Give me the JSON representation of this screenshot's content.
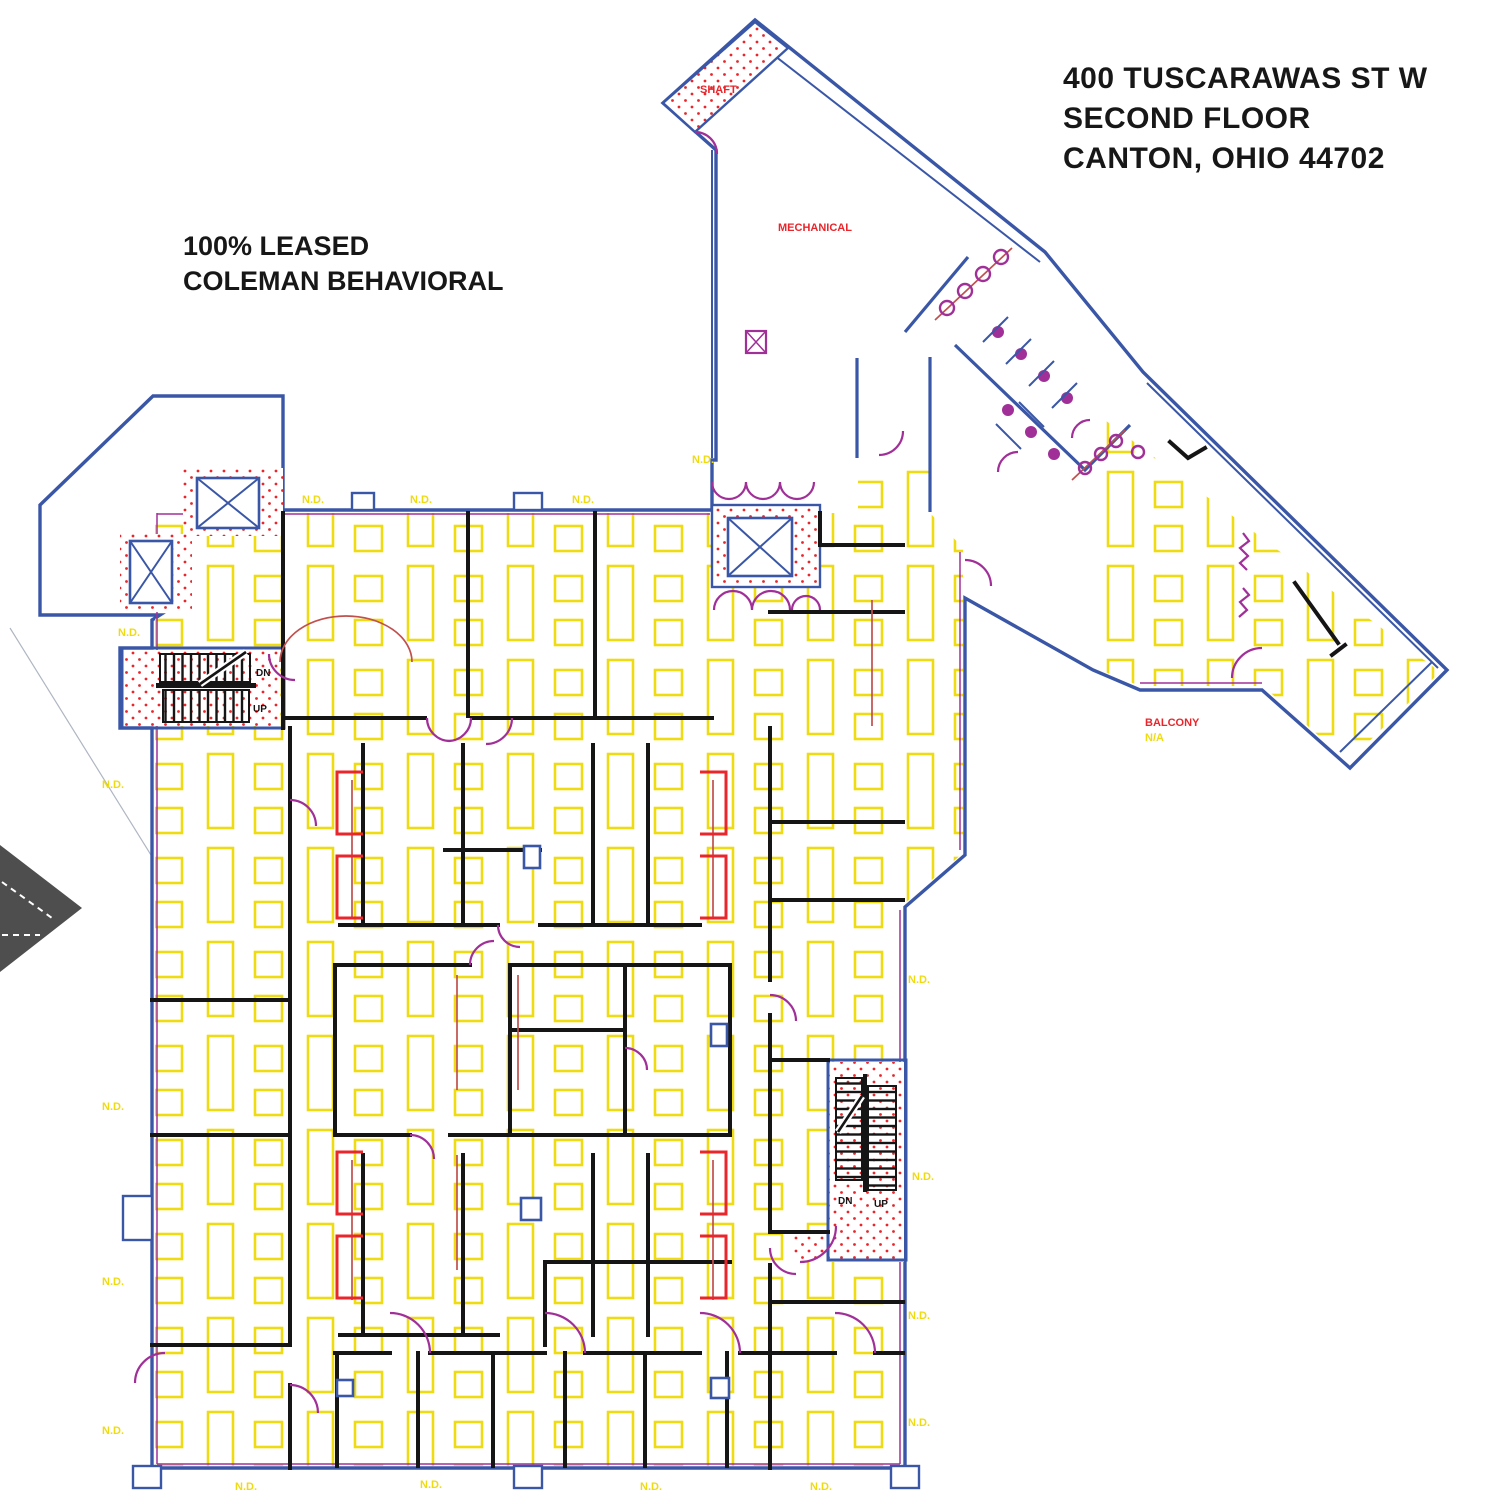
{
  "title_block": {
    "line1": "400 TUSCARAWAS ST W",
    "line2": "SECOND FLOOR",
    "line3": "CANTON, OHIO  44702"
  },
  "lease_note": {
    "line1": "100% LEASED",
    "line2": "COLEMAN BEHAVIORAL"
  },
  "labels": {
    "shaft": "SHAFT",
    "mechanical": "MECHANICAL",
    "balcony": "BALCONY",
    "balcony_na": "N/A",
    "dn": "DN",
    "up": "UP",
    "nd": "N.D."
  },
  "colors": {
    "exterior_wall_blue": "#3A57A7",
    "ceiling_grid_yellow": "#EFDB12",
    "door_magenta": "#A03098",
    "highlight_red": "#E8262B",
    "demo_wall_red": "#C0504D",
    "interior_wall_black": "#151515",
    "context_gray": "#4E4E4E"
  }
}
